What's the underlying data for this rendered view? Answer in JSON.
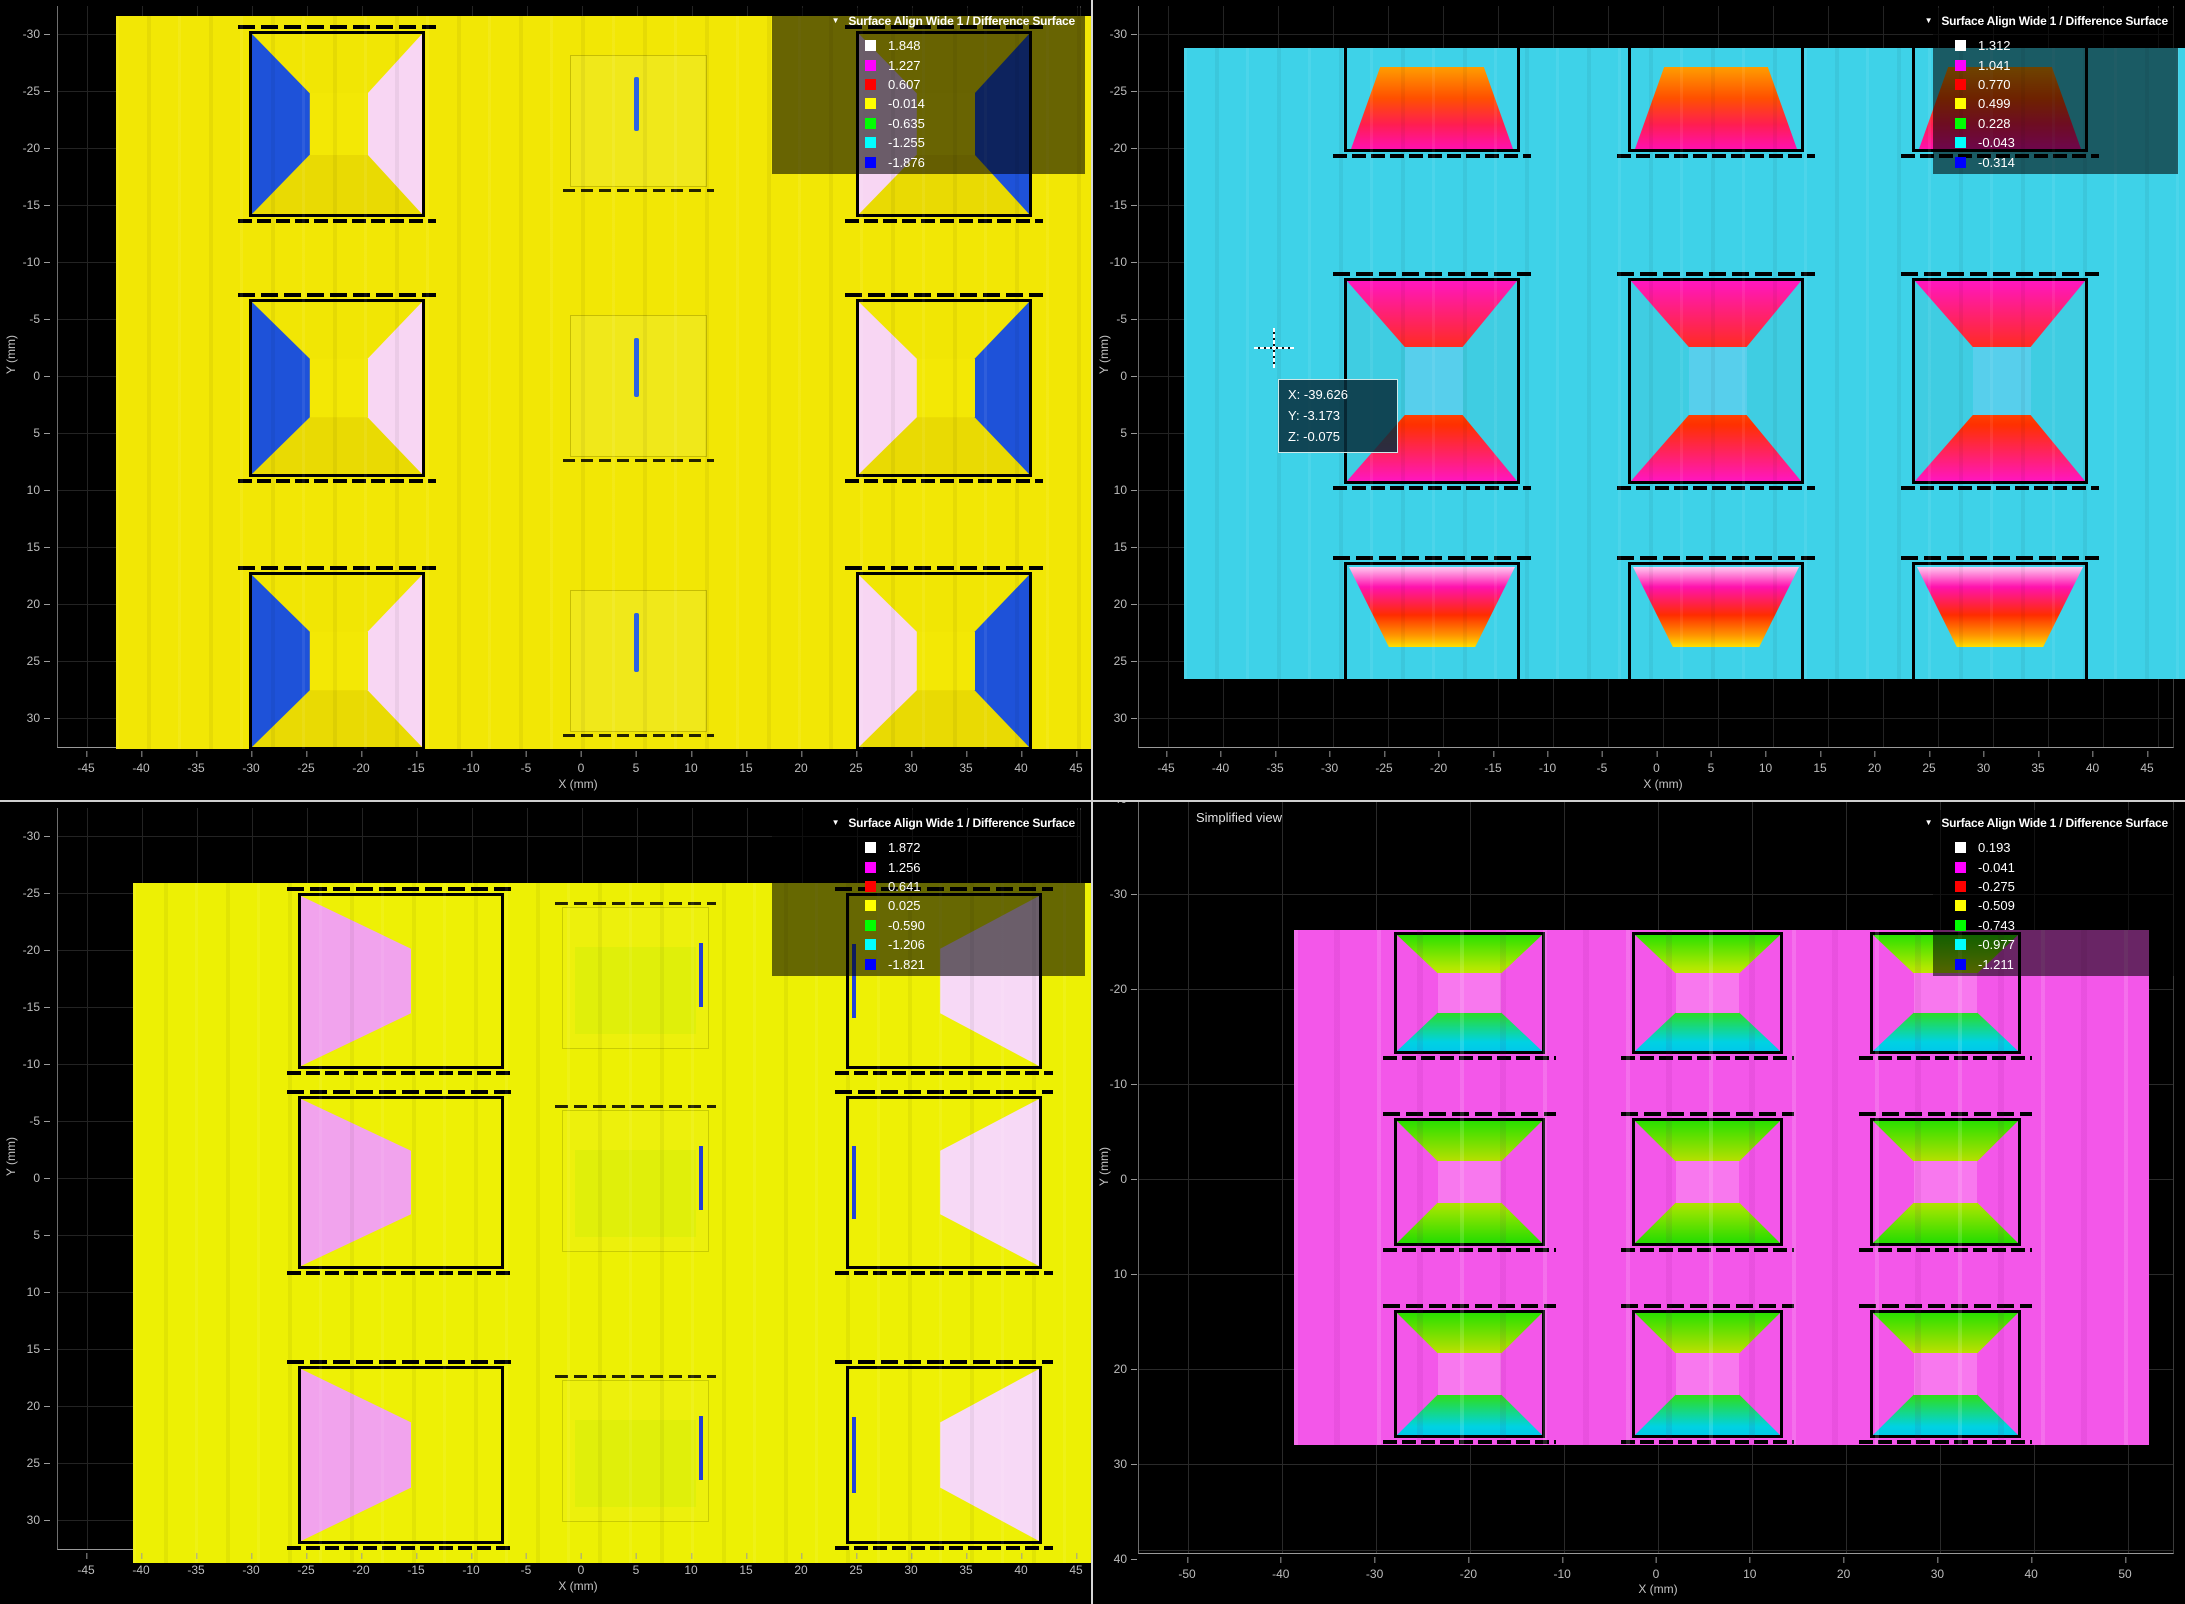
{
  "panels": [
    {
      "id": "top-left",
      "legend_title": "Surface Align Wide 1 / Difference Surface",
      "collapse_icon": "triangle-down",
      "legend": {
        "entries": [
          {
            "color": "#ffffff",
            "value": "1.848"
          },
          {
            "color": "#ff00ff",
            "value": "1.227"
          },
          {
            "color": "#ff0000",
            "value": "0.607"
          },
          {
            "color": "#ffff00",
            "value": "-0.014"
          },
          {
            "color": "#00ff00",
            "value": "-0.635"
          },
          {
            "color": "#00ffff",
            "value": "-1.255"
          },
          {
            "color": "#0000ff",
            "value": "-1.876"
          }
        ]
      },
      "x_axis": {
        "label": "X (mm)",
        "ticks": [
          "-45",
          "-40",
          "-35",
          "-30",
          "-25",
          "-20",
          "-15",
          "-10",
          "-5",
          "0",
          "5",
          "10",
          "15",
          "20",
          "25",
          "30",
          "35",
          "40",
          "45"
        ]
      },
      "y_axis": {
        "label": "Y (mm)",
        "ticks": [
          "-30",
          "-25",
          "-20",
          "-15",
          "-10",
          "-5",
          "0",
          "5",
          "10",
          "15",
          "20",
          "25",
          "30"
        ]
      },
      "dominant_color": "#f2e705"
    },
    {
      "id": "top-right",
      "legend_title": "Surface Align Wide 1 / Difference Surface",
      "collapse_icon": "triangle-down",
      "legend": {
        "entries": [
          {
            "color": "#ffffff",
            "value": "1.312"
          },
          {
            "color": "#ff00ff",
            "value": "1.041"
          },
          {
            "color": "#ff0000",
            "value": "0.770"
          },
          {
            "color": "#ffff00",
            "value": "0.499"
          },
          {
            "color": "#00ff00",
            "value": "0.228"
          },
          {
            "color": "#00ffff",
            "value": "-0.043"
          },
          {
            "color": "#0000ff",
            "value": "-0.314"
          }
        ]
      },
      "x_axis": {
        "label": "X (mm)",
        "ticks": [
          "-45",
          "-40",
          "-35",
          "-30",
          "-25",
          "-20",
          "-15",
          "-10",
          "-5",
          "0",
          "5",
          "10",
          "15",
          "20",
          "25",
          "30",
          "35",
          "40",
          "45"
        ]
      },
      "y_axis": {
        "label": "Y (mm)",
        "ticks": [
          "-30",
          "-25",
          "-20",
          "-15",
          "-10",
          "-5",
          "0",
          "5",
          "10",
          "15",
          "20",
          "25",
          "30"
        ]
      },
      "tooltip": {
        "lines": [
          "X: -39.626",
          "Y: -3.173",
          "Z: -0.075"
        ]
      },
      "dominant_color": "#3ed2e8"
    },
    {
      "id": "bottom-left",
      "legend_title": "Surface Align Wide 1 / Difference Surface",
      "collapse_icon": "triangle-down",
      "legend": {
        "entries": [
          {
            "color": "#ffffff",
            "value": "1.872"
          },
          {
            "color": "#ff00ff",
            "value": "1.256"
          },
          {
            "color": "#ff0000",
            "value": "0.641"
          },
          {
            "color": "#ffff00",
            "value": "0.025"
          },
          {
            "color": "#00ff00",
            "value": "-0.590"
          },
          {
            "color": "#00ffff",
            "value": "-1.206"
          },
          {
            "color": "#0000ff",
            "value": "-1.821"
          }
        ]
      },
      "x_axis": {
        "label": "X (mm)",
        "ticks": [
          "-45",
          "-40",
          "-35",
          "-30",
          "-25",
          "-20",
          "-15",
          "-10",
          "-5",
          "0",
          "5",
          "10",
          "15",
          "20",
          "25",
          "30",
          "35",
          "40",
          "45"
        ]
      },
      "y_axis": {
        "label": "Y (mm)",
        "ticks": [
          "-30",
          "-25",
          "-20",
          "-15",
          "-10",
          "-5",
          "0",
          "5",
          "10",
          "15",
          "20",
          "25",
          "30"
        ]
      },
      "dominant_color": "#edf004"
    },
    {
      "id": "bottom-right",
      "view_label": "Simplified view",
      "legend_title": "Surface Align Wide 1 / Difference Surface",
      "collapse_icon": "triangle-down",
      "legend": {
        "entries": [
          {
            "color": "#ffffff",
            "value": "0.193"
          },
          {
            "color": "#ff00ff",
            "value": "-0.041"
          },
          {
            "color": "#ff0000",
            "value": "-0.275"
          },
          {
            "color": "#ffff00",
            "value": "-0.509"
          },
          {
            "color": "#00ff00",
            "value": "-0.743"
          },
          {
            "color": "#00ffff",
            "value": "-0.977"
          },
          {
            "color": "#0000ff",
            "value": "-1.211"
          }
        ]
      },
      "x_axis": {
        "label": "X (mm)",
        "ticks": [
          "-50",
          "-40",
          "-30",
          "-20",
          "-10",
          "0",
          "10",
          "20",
          "30",
          "40",
          "50"
        ]
      },
      "y_axis": {
        "label": "Y (mm)",
        "ticks": [
          "-40",
          "-30",
          "-20",
          "-10",
          "0",
          "10",
          "20",
          "30",
          "40"
        ]
      },
      "dominant_color": "#f357e9"
    }
  ],
  "chart_data": [
    {
      "type": "heatmap",
      "panel": "top-left",
      "title": "Surface Align Wide 1 / Difference Surface",
      "xlabel": "X (mm)",
      "ylabel": "Y (mm)",
      "xlim": [
        -45,
        45
      ],
      "ylim": [
        -30,
        30
      ],
      "y_axis_inverted": true,
      "color_scale_levels": [
        1.848,
        1.227,
        0.607,
        -0.014,
        -0.635,
        -1.255,
        -1.876
      ],
      "color_scale_colors": [
        "white",
        "magenta",
        "red",
        "yellow",
        "green",
        "cyan",
        "blue"
      ],
      "background_level": -0.014,
      "features": "3x3 array of square pockets (~16 mm, ~27 mm pitch); left-column pockets: blue left sidewall / pale-pink right sidewall; right-column pockets mirrored (pink left / blue right, top-right one partly under legend); middle column near background level with small blue slit"
    },
    {
      "type": "heatmap",
      "panel": "top-right",
      "title": "Surface Align Wide 1 / Difference Surface",
      "xlabel": "X (mm)",
      "ylabel": "Y (mm)",
      "xlim": [
        -45,
        45
      ],
      "ylim": [
        -30,
        30
      ],
      "y_axis_inverted": true,
      "color_scale_levels": [
        1.312,
        1.041,
        0.77,
        0.499,
        0.228,
        -0.043,
        -0.314
      ],
      "color_scale_colors": [
        "white",
        "magenta",
        "red",
        "yellow",
        "green",
        "cyan",
        "blue"
      ],
      "background_level": -0.043,
      "cursor_readout": {
        "X": -39.626,
        "Y": -3.173,
        "Z": -0.075
      },
      "features": "cyan background; 3 columns x 3 rows of pockets; middle row full pockets with rainbow sidewalls (top wall magenta-red-orange-yellow-green downward, bottom wall mirrored), cyan center; top and bottom rows clipped at data edges showing partial gradient trapezoids"
    },
    {
      "type": "heatmap",
      "panel": "bottom-left",
      "title": "Surface Align Wide 1 / Difference Surface",
      "xlabel": "X (mm)",
      "ylabel": "Y (mm)",
      "xlim": [
        -45,
        45
      ],
      "ylim": [
        -30,
        30
      ],
      "y_axis_inverted": true,
      "color_scale_levels": [
        1.872,
        1.256,
        0.641,
        0.025,
        -0.59,
        -1.206,
        -1.821
      ],
      "color_scale_colors": [
        "white",
        "magenta",
        "red",
        "yellow",
        "green",
        "cyan",
        "blue"
      ],
      "background_level": 0.025,
      "features": "yellow-green background; 3x3 pockets; left column shows wide pink left sidewall; right column shows pale-pink right sidewall with thin blue slit on left edge; middle column faint greenish with blue slit"
    },
    {
      "type": "heatmap",
      "panel": "bottom-right",
      "title": "Surface Align Wide 1 / Difference Surface",
      "xlabel": "X (mm)",
      "ylabel": "Y (mm)",
      "xlim": [
        -50,
        50
      ],
      "ylim": [
        -40,
        40
      ],
      "y_axis_inverted": true,
      "color_scale_levels": [
        0.193,
        -0.041,
        -0.275,
        -0.509,
        -0.743,
        -0.977,
        -1.211
      ],
      "color_scale_colors": [
        "white",
        "magenta",
        "red",
        "yellow",
        "green",
        "cyan",
        "blue"
      ],
      "background_level": -0.041,
      "view_label": "Simplified view",
      "features": "magenta background with faint gridlines; 3x3 pockets with rainbow top wall (green-yellow-orange-red downward) and mirrored bottom wall, rows 1 and 3 bottom walls end in cyan; magenta centers"
    }
  ]
}
